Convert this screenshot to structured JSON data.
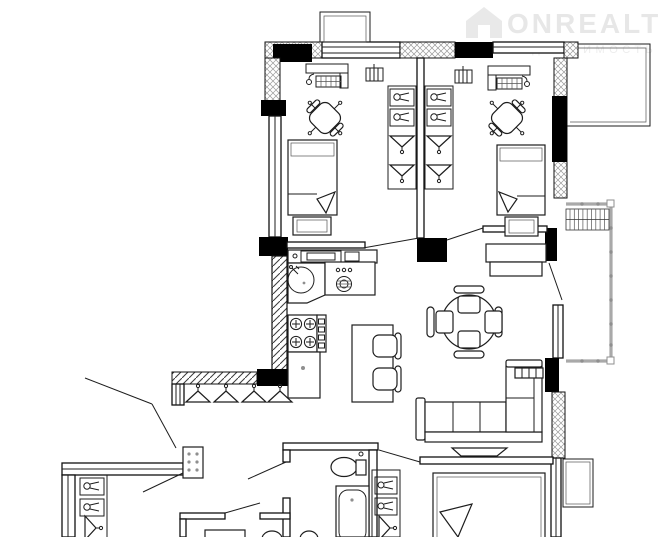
{
  "watermark": {
    "brand": "ONREALT",
    "subtitle": "НЕДВИЖИМОСТЬ",
    "brand_color": "#e7e7e7",
    "subtitle_color": "#ededed",
    "icon": "house-icon"
  },
  "drawing": {
    "type": "apartment-floor-plan",
    "background": "#ffffff",
    "line_color": "#1d1d1d",
    "wall_fill": "#000000",
    "exterior_wall_hatch": "cross-hatch",
    "interior_wall_hatch": "diagonal-hatch",
    "railing_color": "#a9a9a9"
  },
  "rooms": [
    {
      "name": "bedroom-top-left",
      "furniture": [
        "computer-desk",
        "desk-chair",
        "radiator",
        "single-bed",
        "nightstand",
        "wardrobe-shelves",
        "wardrobe-hangers",
        "window"
      ]
    },
    {
      "name": "bedroom-top-right",
      "furniture": [
        "computer-desk",
        "desk-chair",
        "radiator",
        "single-bed",
        "nightstand",
        "tv-stand",
        "wardrobe-shelves",
        "wardrobe-hangers"
      ]
    },
    {
      "name": "kitchen",
      "furniture": [
        "wall-cabinet-row",
        "round-sink",
        "appliance-unit",
        "hob-4-burners",
        "base-cabinet"
      ]
    },
    {
      "name": "living-dining",
      "furniture": [
        "round-table",
        "dining-chairs-4",
        "island-table",
        "chairs-2",
        "corner-sofa",
        "radiator",
        "tv"
      ]
    },
    {
      "name": "hallway",
      "furniture": [
        "coat-rack",
        "hangers-4",
        "dotted-panel",
        "entry-door-swing"
      ]
    },
    {
      "name": "bathroom",
      "furniture": [
        "toilet",
        "bathtub",
        "door-swing"
      ]
    },
    {
      "name": "bedroom-bottom-right",
      "furniture": [
        "double-bed",
        "wardrobe-shelves",
        "wardrobe-hanger",
        "door-swing",
        "window",
        "ac-unit-outside"
      ]
    },
    {
      "name": "closet-bottom-left",
      "furniture": [
        "shelves-2",
        "hanger",
        "door-swing"
      ]
    },
    {
      "name": "balcony",
      "furniture": [
        "railing",
        "drying-rack",
        "balcony-door-swing"
      ]
    }
  ]
}
